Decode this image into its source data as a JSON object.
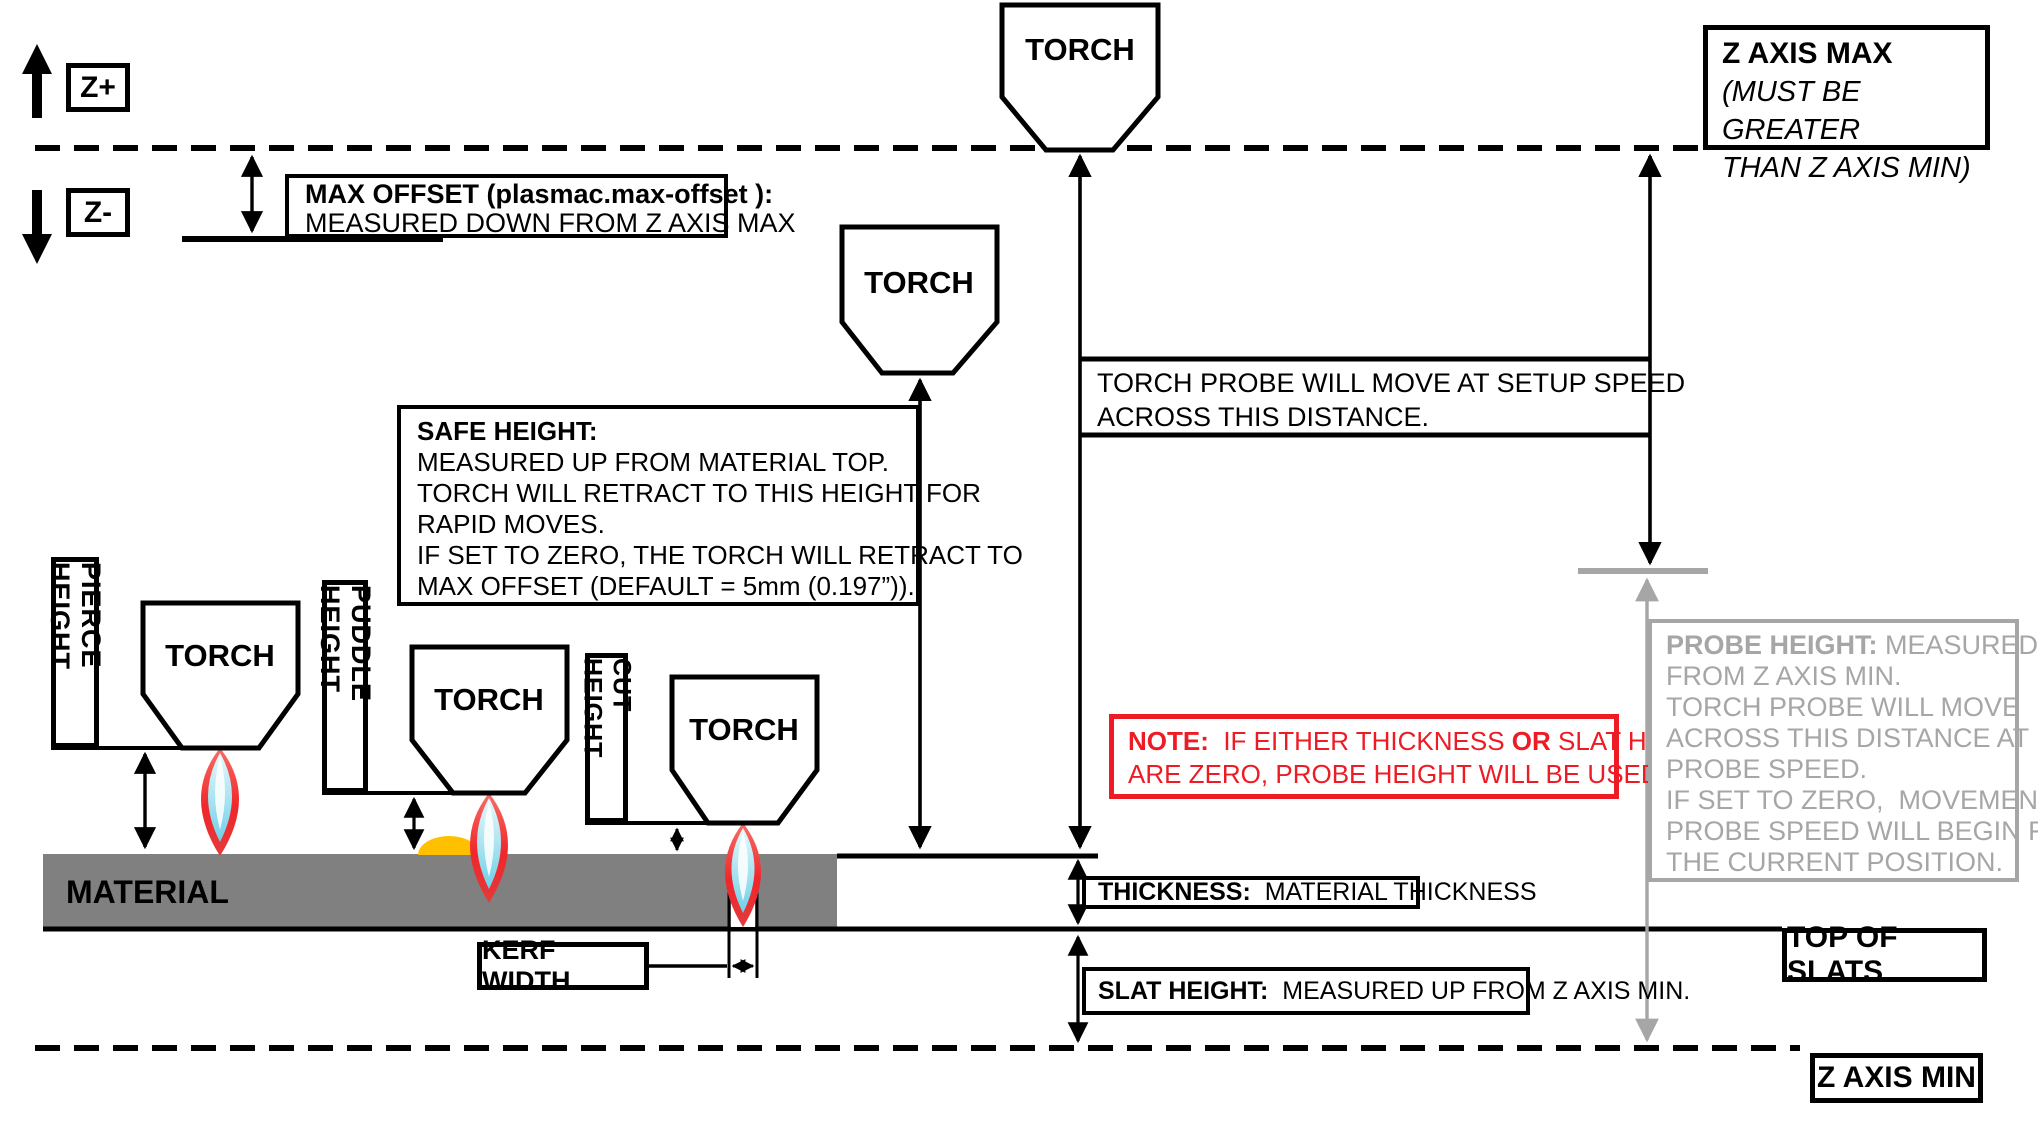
{
  "colors": {
    "line_black": "#000000",
    "material_gray": "#808080",
    "muted_gray": "#a6a6a6",
    "note_red": "#ed1c24",
    "puddle_yellow": "#ffc000",
    "flame_red": "#f23b34",
    "flame_cyan": "#7cd4e8"
  },
  "axis": {
    "z_plus": "Z+",
    "z_minus": "Z-",
    "z_axis_max": {
      "title": "Z AXIS MAX",
      "note_line1": "(MUST BE GREATER",
      "note_line2": "THAN Z AXIS MIN)"
    },
    "z_axis_min": "Z AXIS MIN",
    "top_of_slats": "TOP OF SLATS"
  },
  "torch": {
    "label": "TORCH"
  },
  "max_offset_box": {
    "line1": "MAX OFFSET (plasmac.max-offset ):",
    "line2": "MEASURED DOWN FROM Z AXIS MAX"
  },
  "torch_probe_note": {
    "line1": "TORCH PROBE WILL MOVE AT SETUP SPEED",
    "line2": "ACROSS THIS DISTANCE."
  },
  "safe_height_box": {
    "title": "SAFE HEIGHT:",
    "line1": "MEASURED UP FROM MATERIAL TOP.",
    "line2": "TORCH WILL RETRACT TO THIS HEIGHT FOR",
    "line3": "RAPID MOVES.",
    "line4": "IF SET TO ZERO, THE TORCH WILL RETRACT TO",
    "line5": "MAX OFFSET (DEFAULT = 5mm (0.197”))."
  },
  "height_labels": {
    "pierce": "PIERCE HEIGHT",
    "puddle": "PUDDLE HEIGHT",
    "cut": "CUT HEIGHT",
    "kerf": "KERF WIDTH"
  },
  "material_label": "MATERIAL",
  "note_box": {
    "prefix": "NOTE:",
    "seg1": "  IF EITHER THICKNESS ",
    "or": "OR",
    "seg2": " SLAT HEIGHT",
    "line2": "ARE ZERO, PROBE HEIGHT WILL BE USED."
  },
  "thickness_box": {
    "prefix": "THICKNESS:",
    "text": "  MATERIAL THICKNESS"
  },
  "slat_height_box": {
    "prefix": "SLAT HEIGHT:",
    "text": "  MEASURED UP FROM Z AXIS MIN."
  },
  "probe_height_box": {
    "prefix": "PROBE HEIGHT:",
    "line1_rest": " MEASURED UP",
    "line2": "FROM Z AXIS MIN.",
    "line3": "TORCH PROBE WILL MOVE",
    "line4": "ACROSS THIS DISTANCE AT",
    "line5": "PROBE SPEED.",
    "line6": "IF SET TO ZERO,  MOVEMENT AT",
    "line7": "PROBE SPEED WILL BEGIN FROM",
    "line8": "THE CURRENT POSITION."
  }
}
